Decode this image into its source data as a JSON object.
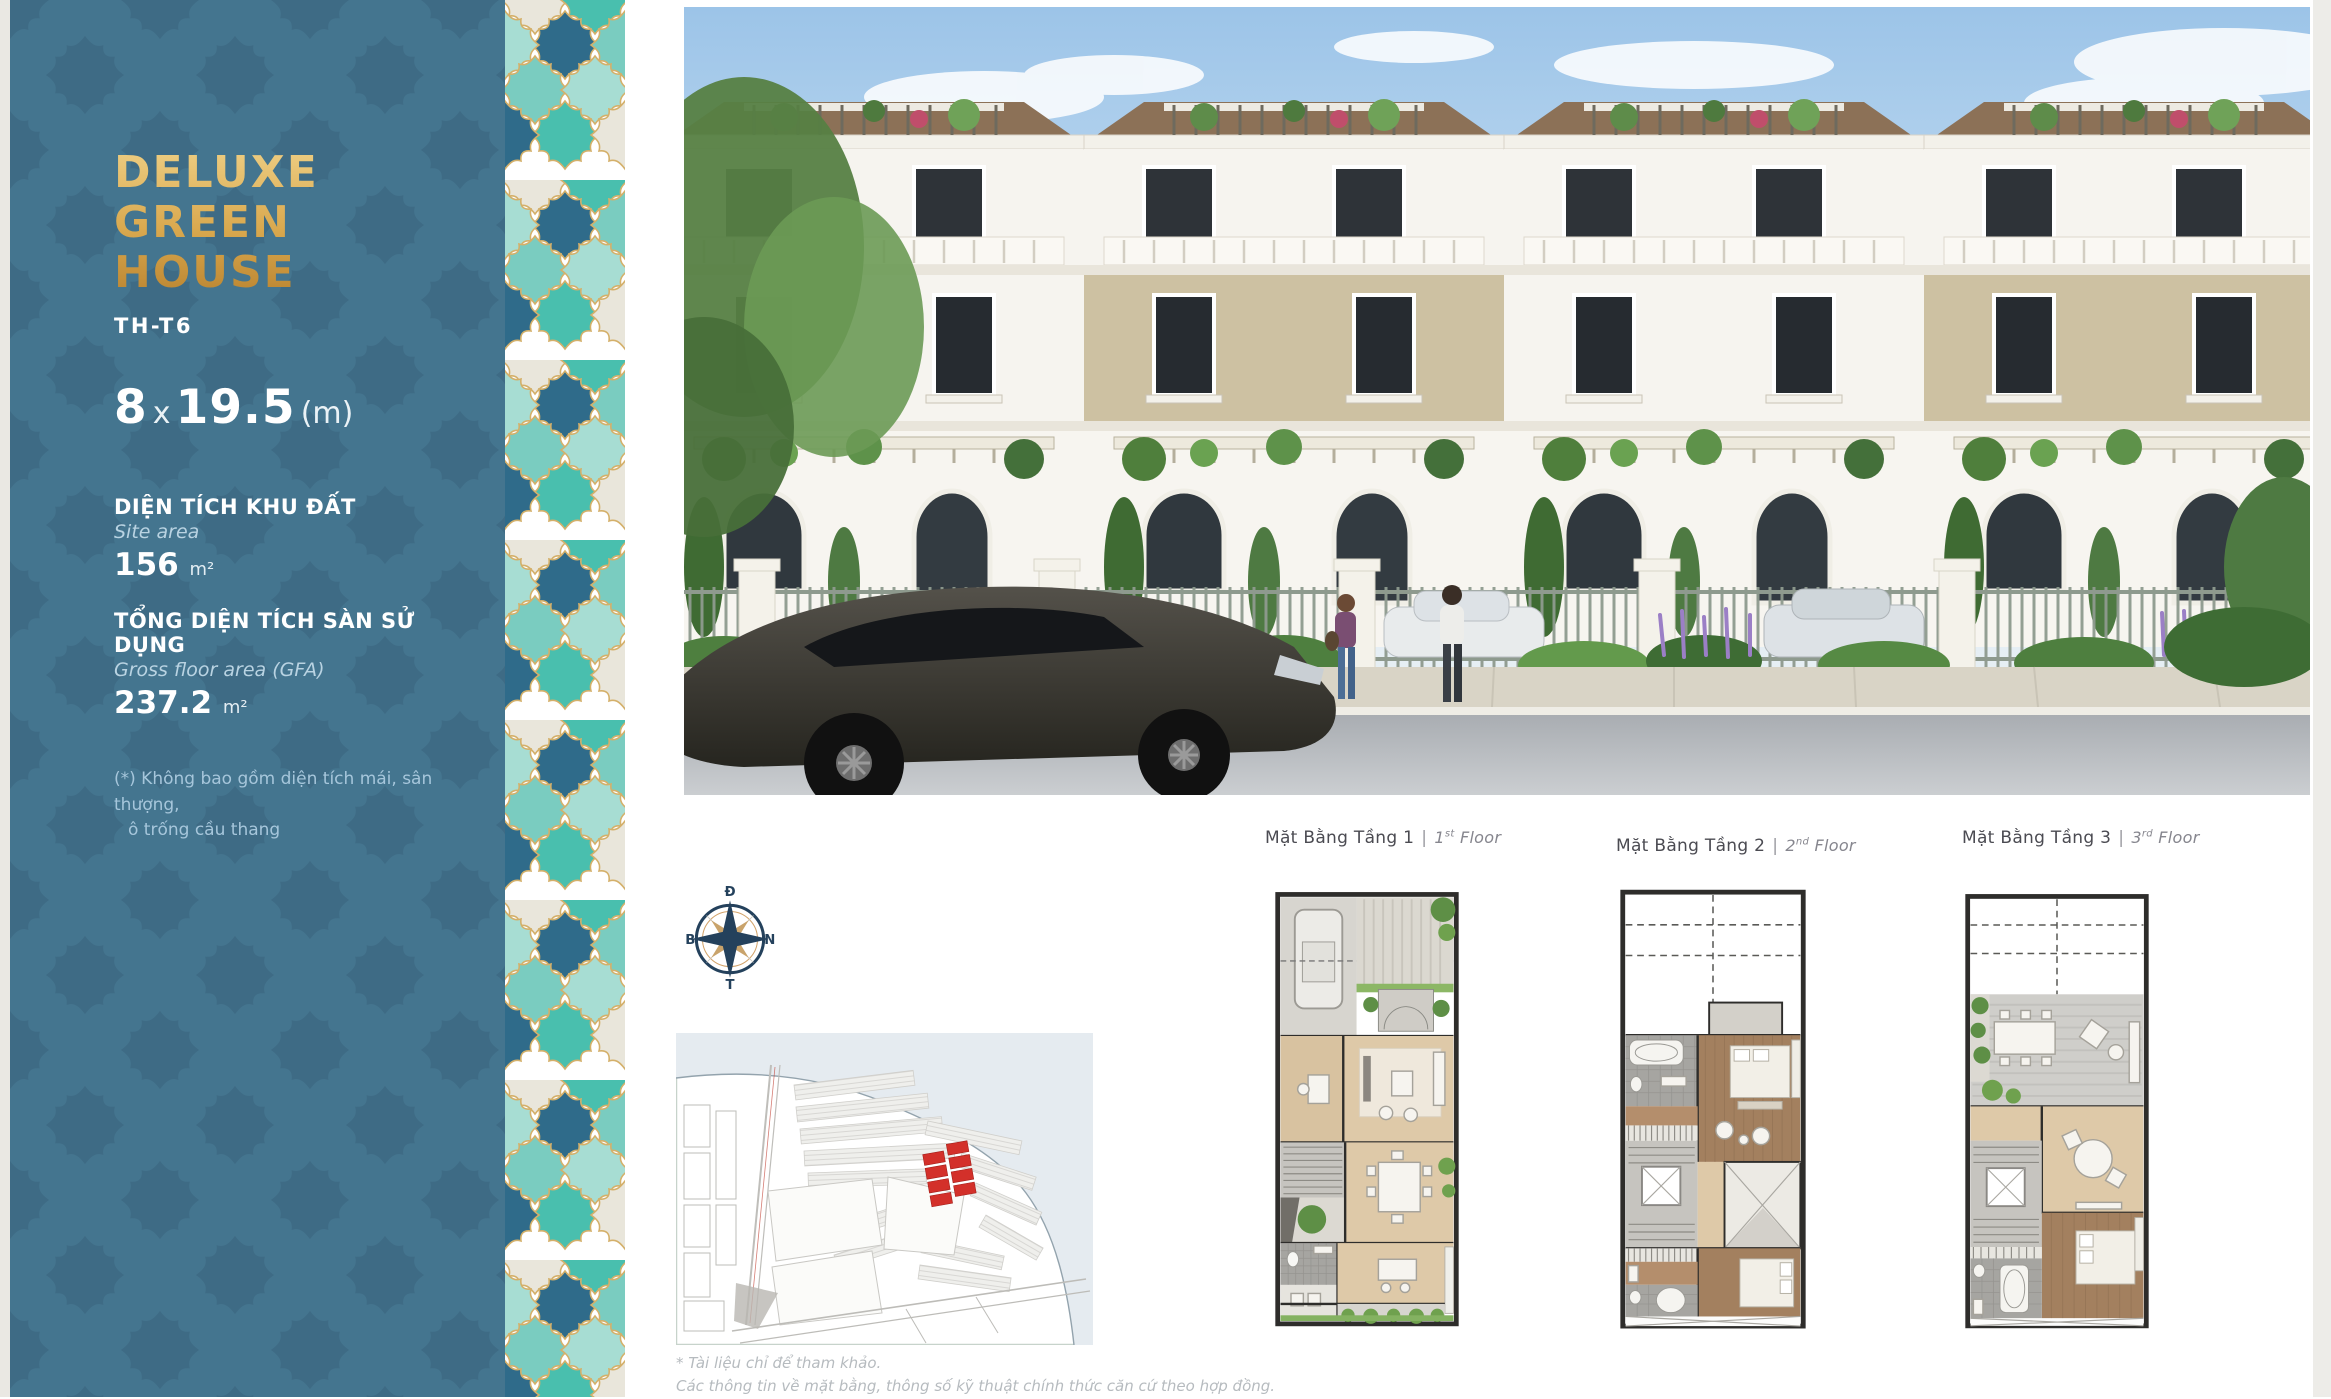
{
  "sidebar": {
    "title_line1": "DELUXE",
    "title_line2": "GREEN HOUSE",
    "code": "TH-T6",
    "dimensions": {
      "width": "8",
      "times": "x",
      "length": "19.5",
      "unit": "(m)"
    },
    "site_area": {
      "label_vi": "DIỆN TÍCH KHU ĐẤT",
      "label_en": "Site area",
      "value": "156",
      "unit": "m²"
    },
    "gfa": {
      "label_vi": "TỔNG DIỆN TÍCH SÀN SỬ DỤNG",
      "label_en": "Gross floor area (GFA)",
      "value": "237.2",
      "unit": "m²"
    },
    "footnote_line1": "(*) Không bao gồm diện tích mái, sân thượng,",
    "footnote_line2": "ô trống cầu thang"
  },
  "plans": {
    "separator": "|",
    "items": [
      {
        "vi": "Mặt Bằng Tầng 1",
        "num": "1",
        "ord": "st",
        "word": "Floor"
      },
      {
        "vi": "Mặt Bằng Tầng 2",
        "num": "2",
        "ord": "nd",
        "word": "Floor"
      },
      {
        "vi": "Mặt Bằng Tầng 3",
        "num": "3",
        "ord": "rd",
        "word": "Floor"
      }
    ]
  },
  "compass": {
    "top": "Đ",
    "right": "N",
    "bottom": "T",
    "left": "B"
  },
  "disclaimer": {
    "line1": "* Tài liệu chỉ để tham khảo.",
    "line2": "Các thông tin về mặt bằng, thông số kỹ thuật chính thức căn cứ theo hợp đồng."
  },
  "colors": {
    "sidebar_blue": "#44758F",
    "accent_gold": "#D9A84E",
    "tile_teal": "#49BFAE",
    "tile_navy": "#2F6B8A",
    "highlight_red": "#D3302A"
  }
}
